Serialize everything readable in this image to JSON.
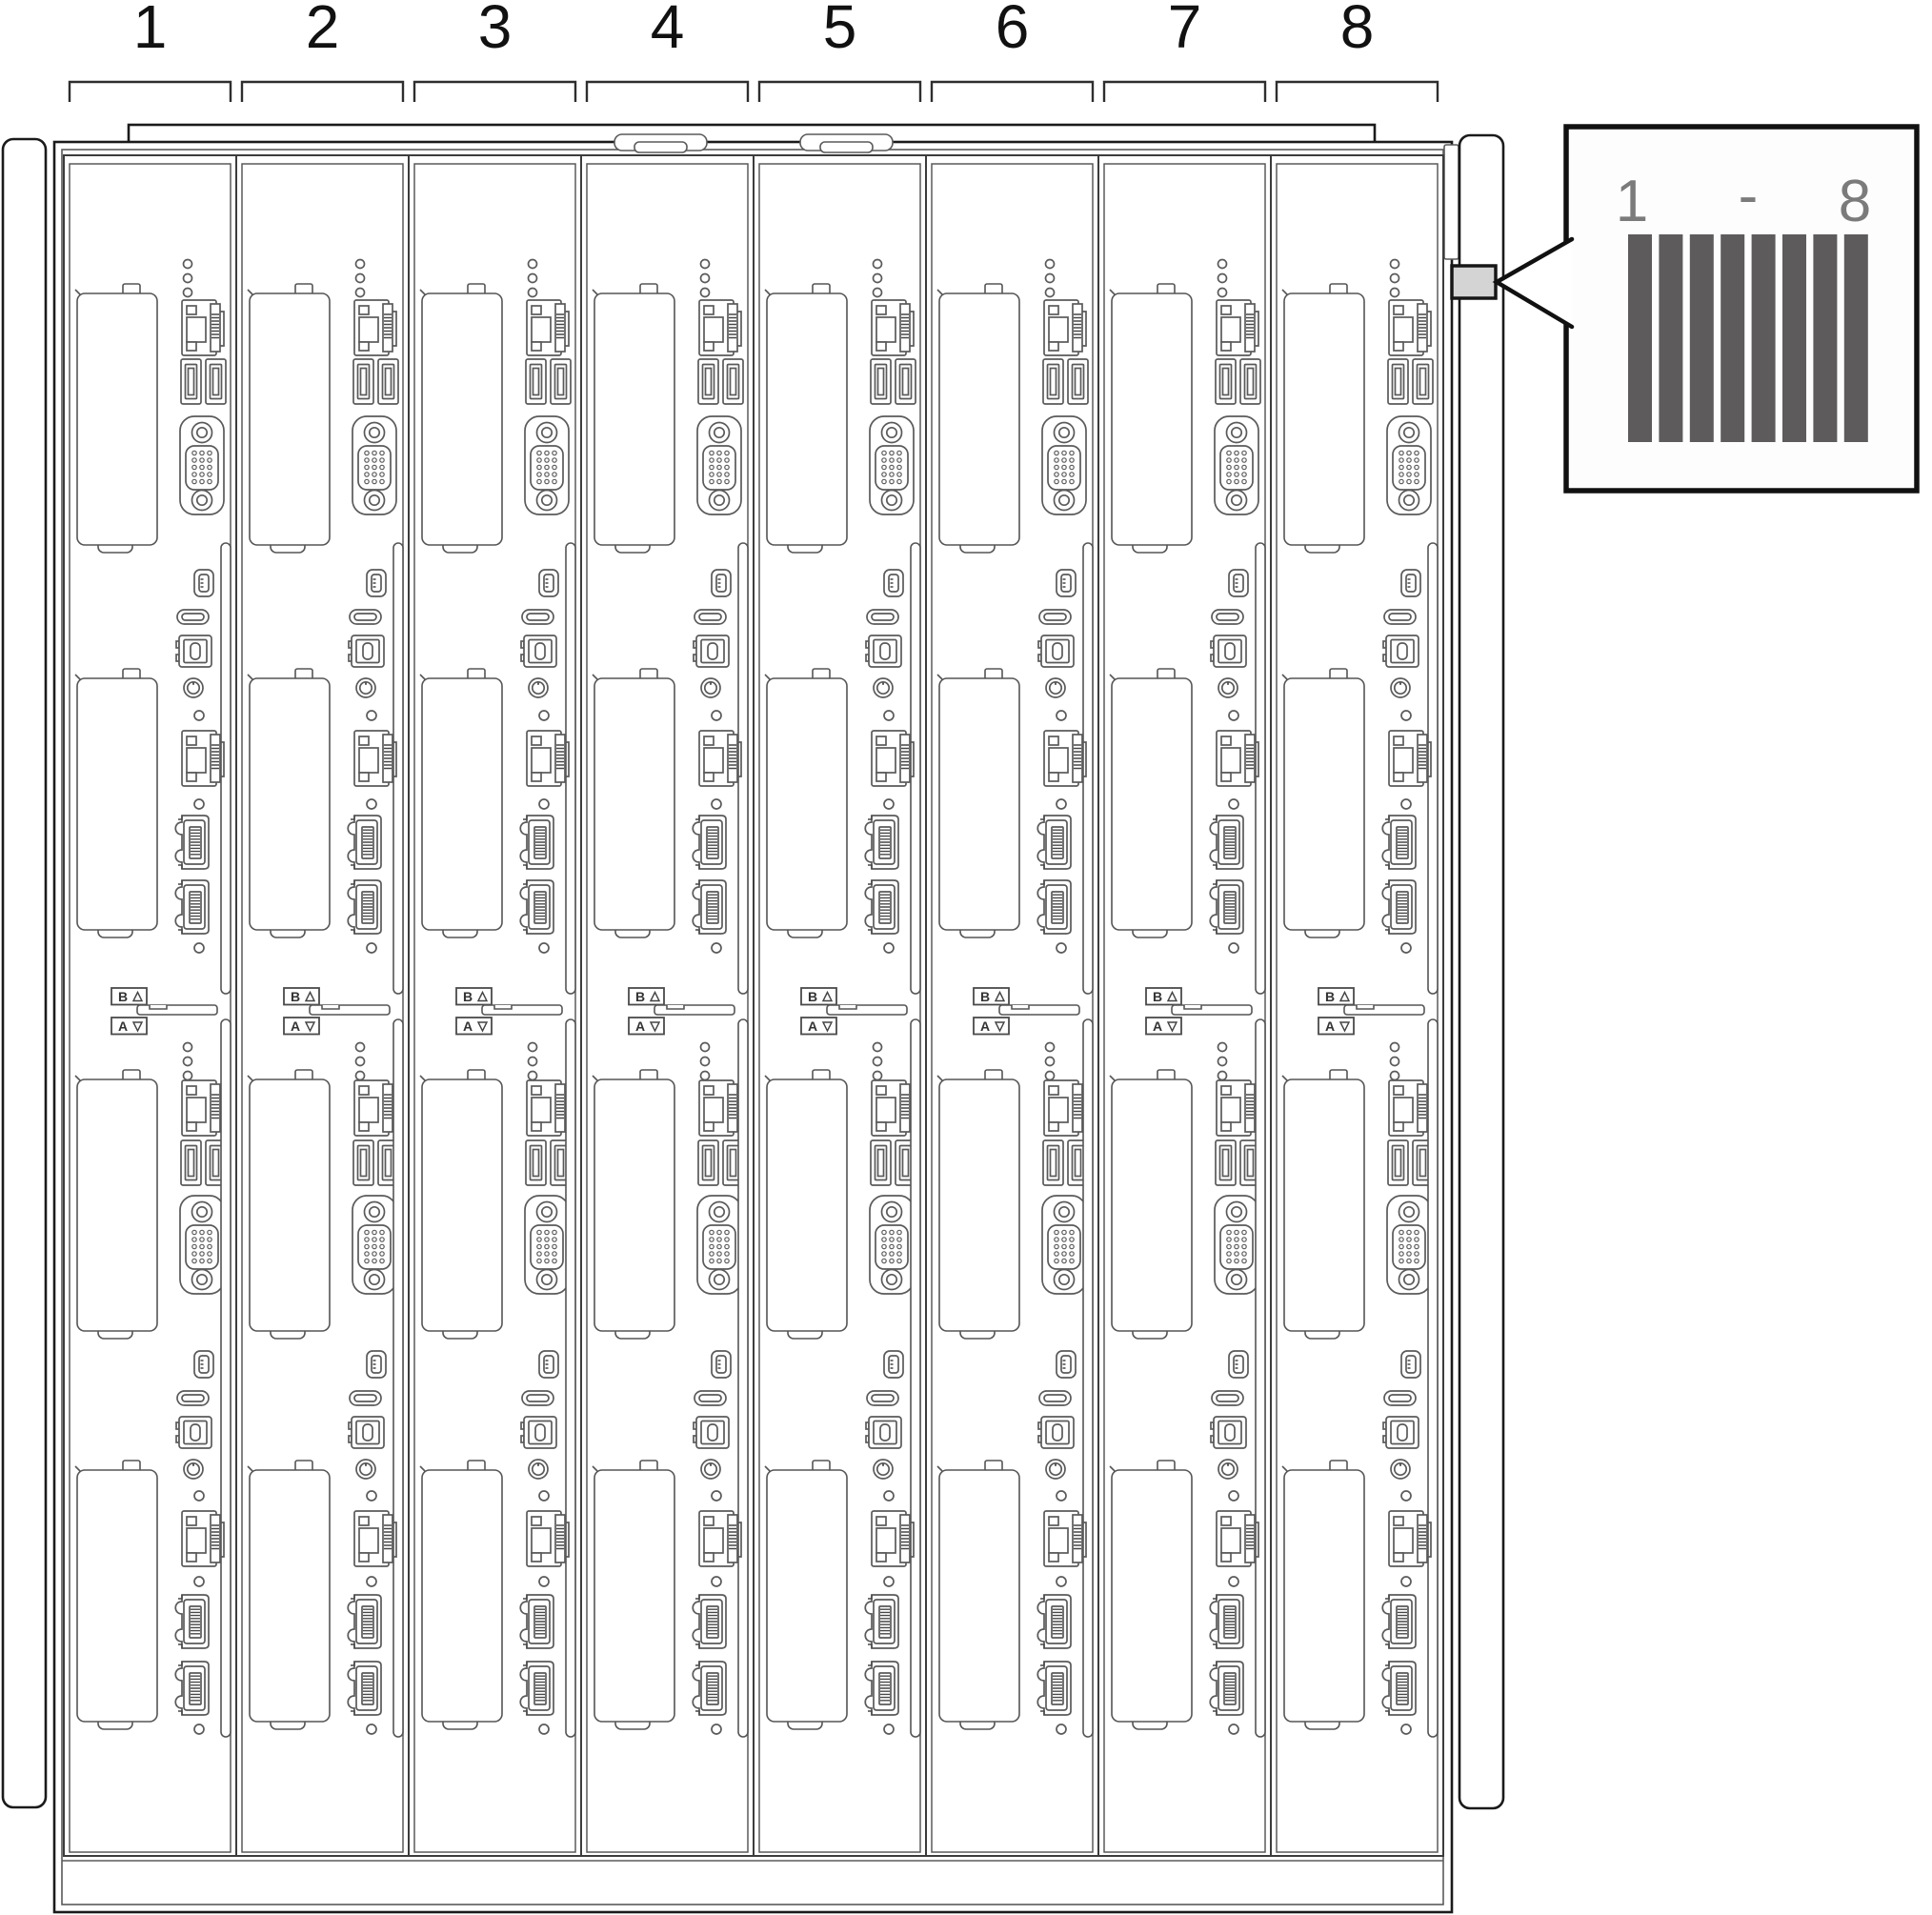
{
  "slots": [
    {
      "number": "1"
    },
    {
      "number": "2"
    },
    {
      "number": "3"
    },
    {
      "number": "4"
    },
    {
      "number": "5"
    },
    {
      "number": "6"
    },
    {
      "number": "7"
    },
    {
      "number": "8"
    }
  ],
  "tray_labels": {
    "upper": "B",
    "upper_arrow": "△",
    "lower": "A",
    "lower_arrow": "▽"
  },
  "callout": {
    "start": "1",
    "separator": "-",
    "end": "8",
    "bar_count": 8
  },
  "colors": {
    "background": "#ffffff",
    "line": "#5a5a5a",
    "outline_dark": "#1a1a1a",
    "label_fill": "#d4d4d4",
    "callout_bar": "#5d5b5b",
    "callout_text": "#7b7b7b"
  }
}
